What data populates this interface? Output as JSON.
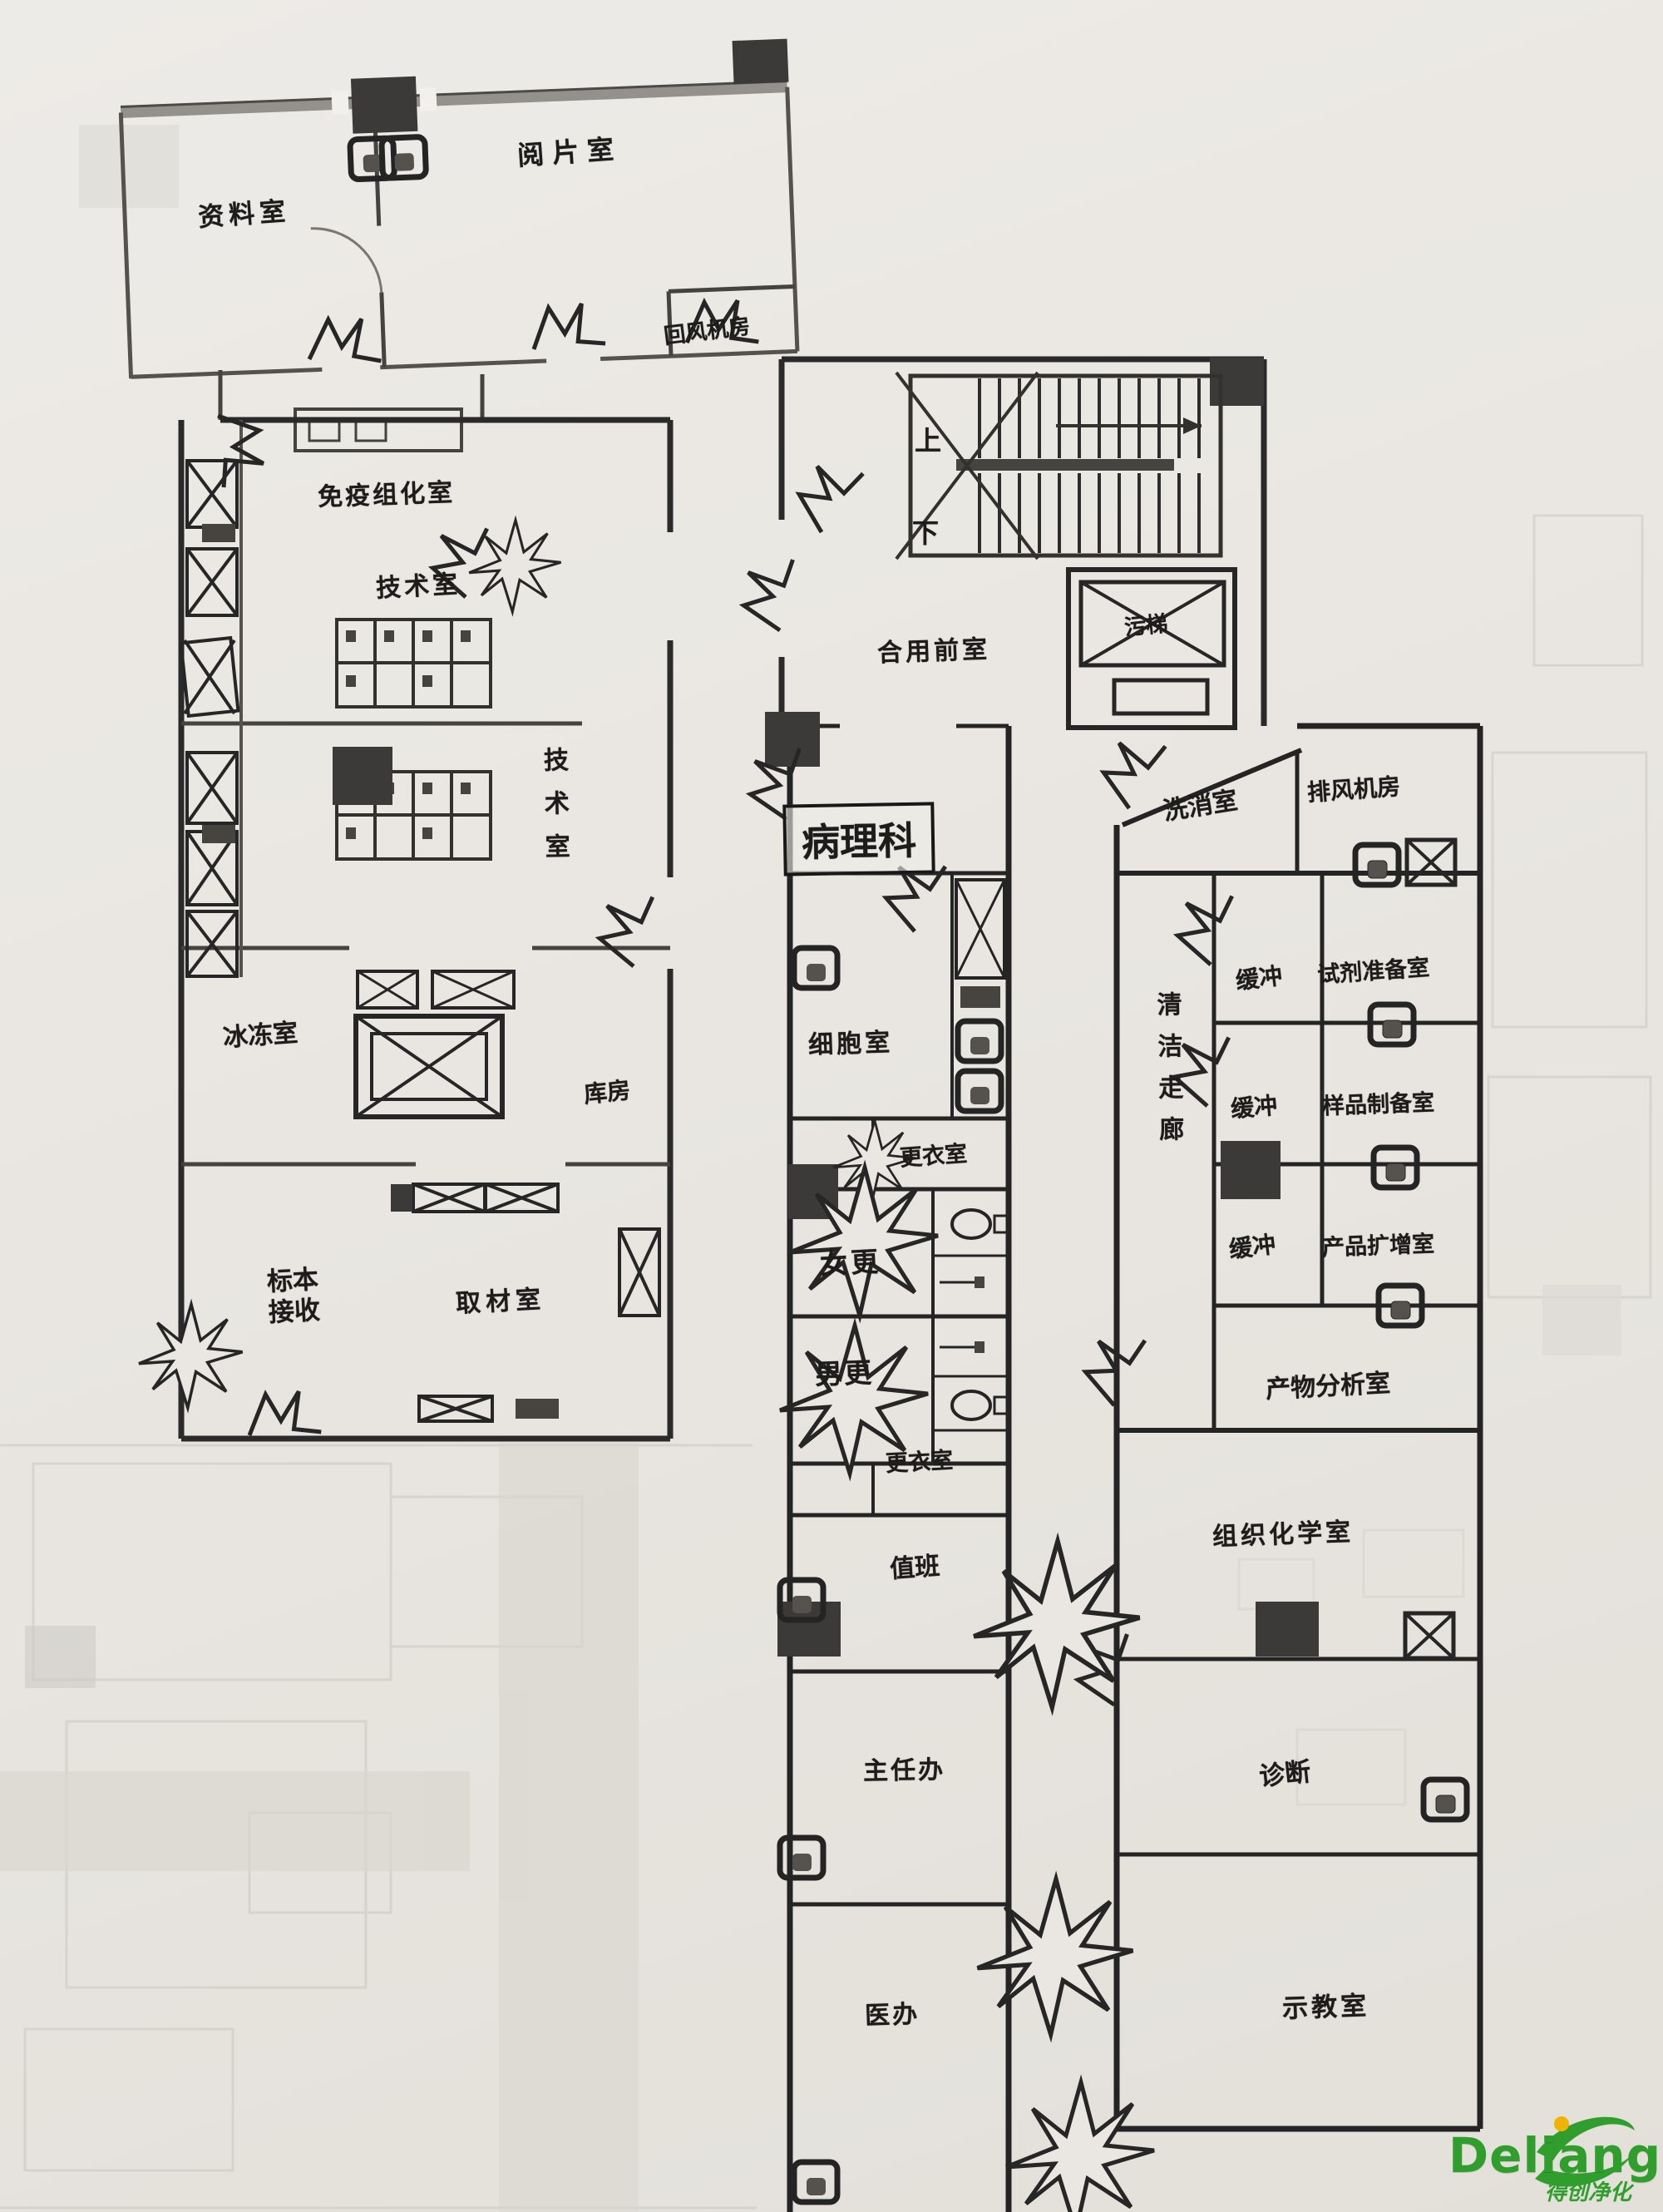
{
  "plan": {
    "department_label": "病理科",
    "stairs": {
      "up": "上",
      "down": "下"
    },
    "rooms": {
      "archive": "资料室",
      "film_reading": "阅片室",
      "air_handling_room": "回风机房",
      "shared_lobby": "合用前室",
      "dirty_elevator": "污梯",
      "immuno_room": "免疫组化室",
      "tech_room_1": "技术室",
      "tech_room_2": "技术室",
      "frozen_section_room": "冰冻室",
      "storage_room": "库房",
      "specimen_receiving": "标本接收",
      "grossing_room": "取材室",
      "cytology_room": "细胞室",
      "changing_room_top": "更衣室",
      "female_changing": "女更",
      "male_changing": "男更",
      "changing_room_bottom": "更衣室",
      "duty_room": "值班",
      "director_office": "主任办",
      "doctor_office": "医办",
      "wash_room": "洗消室",
      "exhaust_fan_room": "排风机房",
      "clean_corridor": "清洁走廊",
      "buffer_1": "缓冲",
      "reagent_prep_room": "试剂准备室",
      "buffer_2": "缓冲",
      "sample_prep_room": "样品制备室",
      "buffer_3": "缓冲",
      "amplification_room": "产品扩增室",
      "product_analysis_room": "产物分析室",
      "histochemistry_room": "组织化学室",
      "diagnosis_room": "诊断",
      "teaching_room": "示教室"
    },
    "watermark": {
      "brand": "Deliang",
      "caption": "得创净化",
      "color": "#2f9e2c"
    }
  }
}
